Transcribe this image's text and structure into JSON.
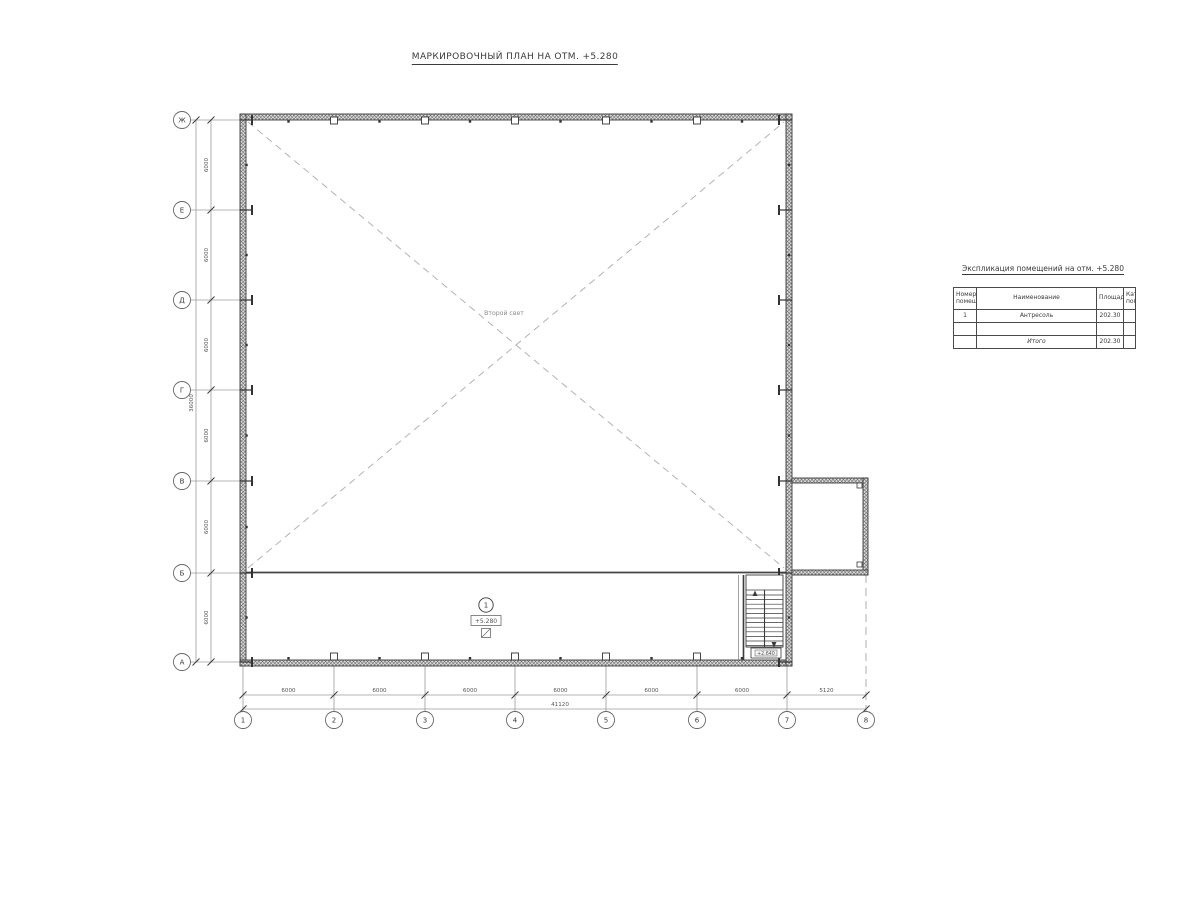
{
  "colors": {
    "wall_line": "#3a3a3a",
    "aux_line": "#9b9b9b",
    "void_dash": "#b3b3b3",
    "dim_text": "#555555"
  },
  "title": "МАРКИРОВОЧНЫЙ ПЛАН НА ОТМ. +5.280",
  "explication": {
    "title": "Экспликация помещений на отм. +5.280",
    "col_number": "Номер\nпомещ.",
    "col_name": "Наименование",
    "col_area": "Площадь",
    "col_category": "Кат.\nпом.",
    "row1": {
      "number": "1",
      "name": "Антресоль",
      "area": "202.30",
      "category": ""
    },
    "row2": {
      "number": "",
      "name": "",
      "area": "",
      "category": ""
    },
    "total_label": "Итого",
    "total_area": "202.30"
  },
  "axes": {
    "rows": [
      "Ж",
      "Е",
      "Д",
      "Г",
      "В",
      "Б",
      "А"
    ],
    "cols": [
      "1",
      "2",
      "3",
      "4",
      "5",
      "6",
      "7",
      "8"
    ]
  },
  "dims": {
    "left": [
      "6000",
      "6000",
      "6000",
      "6000",
      "6000",
      "6000"
    ],
    "left_total": "36000",
    "bottom": [
      "6000",
      "6000",
      "6000",
      "6000",
      "6000",
      "6000",
      "5120"
    ],
    "bottom_total": "41120"
  },
  "plan_labels": {
    "void_label": "Второй свет",
    "room_number": "1",
    "room_level": "+5.280",
    "stair_level": "+2.640"
  }
}
